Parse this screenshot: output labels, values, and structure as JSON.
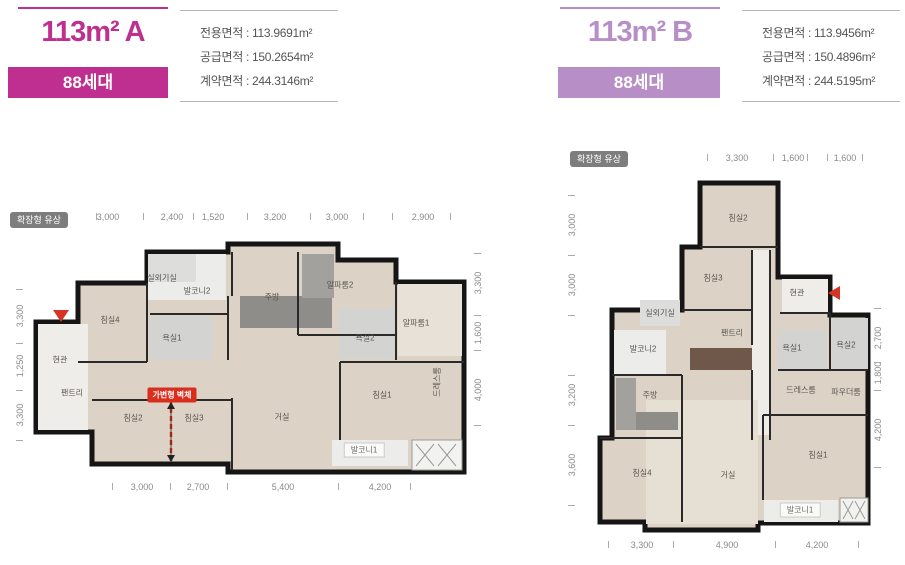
{
  "units": [
    {
      "id": "A",
      "title": "113m² A",
      "households": "88세대",
      "theme_color": "#bf2f90",
      "areas": [
        "전용면적 : 113.9691m²",
        "공급면적 : 150.2654m²",
        "계약면적 : 244.3146m²"
      ],
      "badge": "확장형 유상",
      "movable_wall": "가변형 벽체",
      "rooms": [
        {
          "label": "침실4",
          "x": 110,
          "y": 320
        },
        {
          "label": "현관",
          "x": 60,
          "y": 360
        },
        {
          "label": "팬트리",
          "x": 72,
          "y": 393
        },
        {
          "label": "실외기실",
          "x": 162,
          "y": 278
        },
        {
          "label": "발코니2",
          "x": 197,
          "y": 291
        },
        {
          "label": "욕실1",
          "x": 172,
          "y": 338
        },
        {
          "label": "주방",
          "x": 272,
          "y": 297
        },
        {
          "label": "알파룸2",
          "x": 340,
          "y": 285
        },
        {
          "label": "알파룸1",
          "x": 416,
          "y": 323
        },
        {
          "label": "욕실2",
          "x": 365,
          "y": 338
        },
        {
          "label": "드레스룸",
          "x": 437,
          "y": 382,
          "vertical": true
        },
        {
          "label": "침실2",
          "x": 133,
          "y": 418
        },
        {
          "label": "침실3",
          "x": 194,
          "y": 418
        },
        {
          "label": "거실",
          "x": 282,
          "y": 417
        },
        {
          "label": "침실1",
          "x": 382,
          "y": 395
        },
        {
          "label": "발코니1",
          "x": 364,
          "y": 450,
          "chip": true
        }
      ],
      "dims": {
        "top": {
          "y": 217,
          "labels": [
            [
              "3,000",
              108
            ],
            [
              "2,400",
              172
            ],
            [
              "1,520",
              213
            ],
            [
              "3,200",
              275
            ],
            [
              "3,000",
              337
            ],
            [
              "2,900",
              423
            ]
          ],
          "ticks": [
            96,
            143,
            193,
            247,
            310,
            363,
            392,
            450
          ]
        },
        "bottom": {
          "y": 487,
          "labels": [
            [
              "3,000",
              142
            ],
            [
              "2,700",
              198
            ],
            [
              "5,400",
              283
            ],
            [
              "4,200",
              380
            ]
          ],
          "ticks": [
            112,
            170,
            227,
            338,
            410
          ]
        },
        "left": {
          "x": 20,
          "labels": [
            [
              "3,300",
              316
            ],
            [
              "1,250",
              366
            ],
            [
              "3,300",
              415
            ]
          ],
          "ticks": [
            289,
            343,
            390,
            440
          ]
        },
        "right": {
          "x": 478,
          "labels": [
            [
              "3,300",
              283
            ],
            [
              "1,600",
              333
            ],
            [
              "4,000",
              390
            ]
          ],
          "ticks": [
            253,
            315,
            350,
            425
          ]
        }
      }
    },
    {
      "id": "B",
      "title": "113m² B",
      "households": "88세대",
      "theme_color": "#b78fc6",
      "areas": [
        "전용면적 : 113.9456m²",
        "공급면적 : 150.4896m²",
        "계약면적 : 244.5195m²"
      ],
      "badge": "확장형 유상",
      "rooms": [
        {
          "label": "침실2",
          "x": 738,
          "y": 218
        },
        {
          "label": "침실3",
          "x": 713,
          "y": 278
        },
        {
          "label": "현관",
          "x": 797,
          "y": 293
        },
        {
          "label": "실외기실",
          "x": 660,
          "y": 313
        },
        {
          "label": "발코니2",
          "x": 643,
          "y": 349
        },
        {
          "label": "팬트리",
          "x": 732,
          "y": 333
        },
        {
          "label": "욕실1",
          "x": 792,
          "y": 348
        },
        {
          "label": "욕실2",
          "x": 846,
          "y": 345
        },
        {
          "label": "주방",
          "x": 650,
          "y": 395
        },
        {
          "label": "드레스룸",
          "x": 801,
          "y": 390
        },
        {
          "label": "파우더룸",
          "x": 846,
          "y": 392
        },
        {
          "label": "침실4",
          "x": 642,
          "y": 473
        },
        {
          "label": "거실",
          "x": 728,
          "y": 475
        },
        {
          "label": "침실1",
          "x": 818,
          "y": 455
        },
        {
          "label": "발코니1",
          "x": 800,
          "y": 510,
          "chip": true
        }
      ],
      "dims": {
        "top": {
          "y": 158,
          "labels": [
            [
              "3,300",
              737
            ],
            [
              "1,600",
              793
            ],
            [
              "1,600",
              845
            ]
          ],
          "ticks": [
            707,
            773,
            807,
            827,
            862
          ]
        },
        "bottom": {
          "y": 545,
          "labels": [
            [
              "3,300",
              642
            ],
            [
              "4,900",
              727
            ],
            [
              "4,200",
              817
            ]
          ],
          "ticks": [
            608,
            673,
            775,
            858
          ]
        },
        "left": {
          "x": 572,
          "labels": [
            [
              "3,000",
              225
            ],
            [
              "3,000",
              285
            ],
            [
              "3,200",
              395
            ],
            [
              "3,600",
              465
            ]
          ],
          "ticks": [
            195,
            255,
            315,
            375,
            425,
            505
          ]
        },
        "right": {
          "x": 878,
          "labels": [
            [
              "2,700",
              338
            ],
            [
              "1,800",
              373
            ],
            [
              "4,200",
              430
            ]
          ],
          "ticks": [
            308,
            362,
            390,
            467
          ]
        }
      }
    }
  ]
}
